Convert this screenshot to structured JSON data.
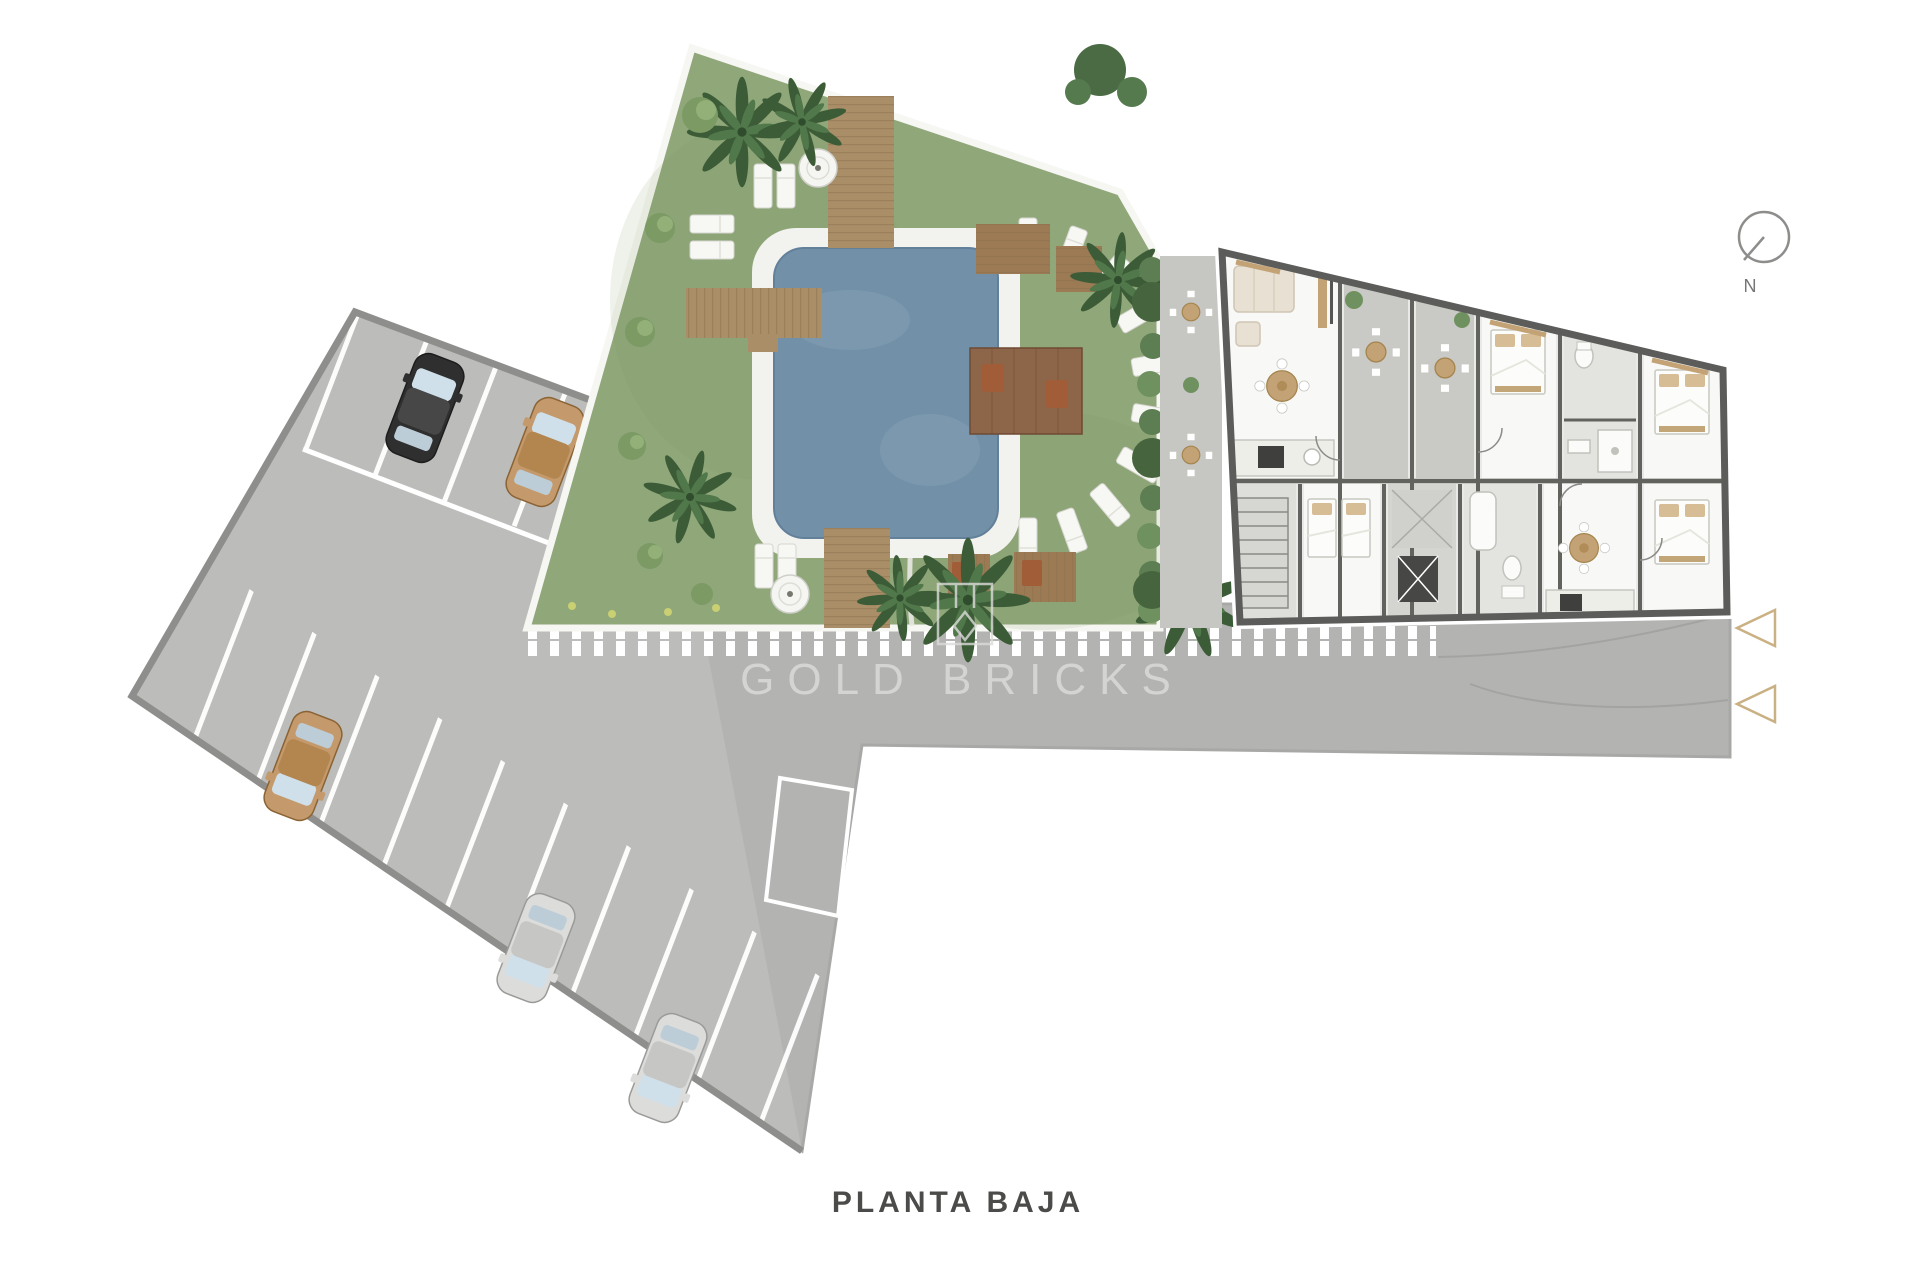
{
  "labels": {
    "plan_title": "PLANTA BAJA",
    "watermark": "GOLD BRICKS",
    "compass_north": "N"
  },
  "colors": {
    "background": "#ffffff",
    "pavement": "#b3b3b1",
    "parking": "#bcbcba",
    "wall": "#8e8e8c",
    "stripe": "#ffffff",
    "grass": "#90a77a",
    "pool": "#7291a8",
    "pool_deck": "#f2f2ee",
    "wood": "#a98e68",
    "wood_dark": "#8a6f4e",
    "pergola": "#8d6548",
    "building_floor": "#e9e9e7",
    "building_wall": "#5c5c5a",
    "room_white": "#f8f8f6",
    "terrace": "#c6c6c3",
    "tile": "#e3e3e0",
    "tan_wood": "#c3a375",
    "beige": "#e8e0d3",
    "palm_green": "#3c5c38",
    "palm_light": "#50784a",
    "hedge_green": "#5d7d52",
    "gold_accent": "#c9b184",
    "title_gray": "#4b4b49"
  },
  "cars": [
    {
      "id": "car-black-top",
      "body": "#2f2f2f",
      "roof": "#474747"
    },
    {
      "id": "car-tan-top",
      "body": "#c49a6c",
      "roof": "#b3854f"
    },
    {
      "id": "car-tan-left",
      "body": "#c49a6c",
      "roof": "#b3854f"
    },
    {
      "id": "car-silver-mid",
      "body": "#dcdcda",
      "roof": "#c6c6c4"
    },
    {
      "id": "car-silver-low",
      "body": "#dcdcda",
      "roof": "#c6c6c4"
    }
  ]
}
